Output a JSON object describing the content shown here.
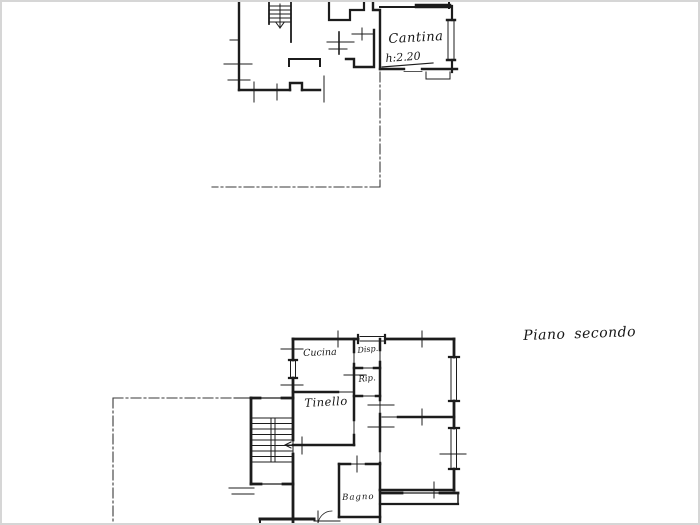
{
  "page": {
    "paper_color": "#ffffff",
    "ink_color": "#1c1c1c",
    "edge_color": "#d6d6d6"
  },
  "upper_plan": {
    "rooms": [
      {
        "label": "Cantina",
        "height_note": "h:2.20"
      }
    ]
  },
  "lower_plan": {
    "caption": "Piano secondo",
    "rooms": [
      {
        "label": "Cucina"
      },
      {
        "label": "Disp."
      },
      {
        "label": "Rip."
      },
      {
        "label": "Tinello"
      },
      {
        "label": "Bagno"
      }
    ]
  }
}
